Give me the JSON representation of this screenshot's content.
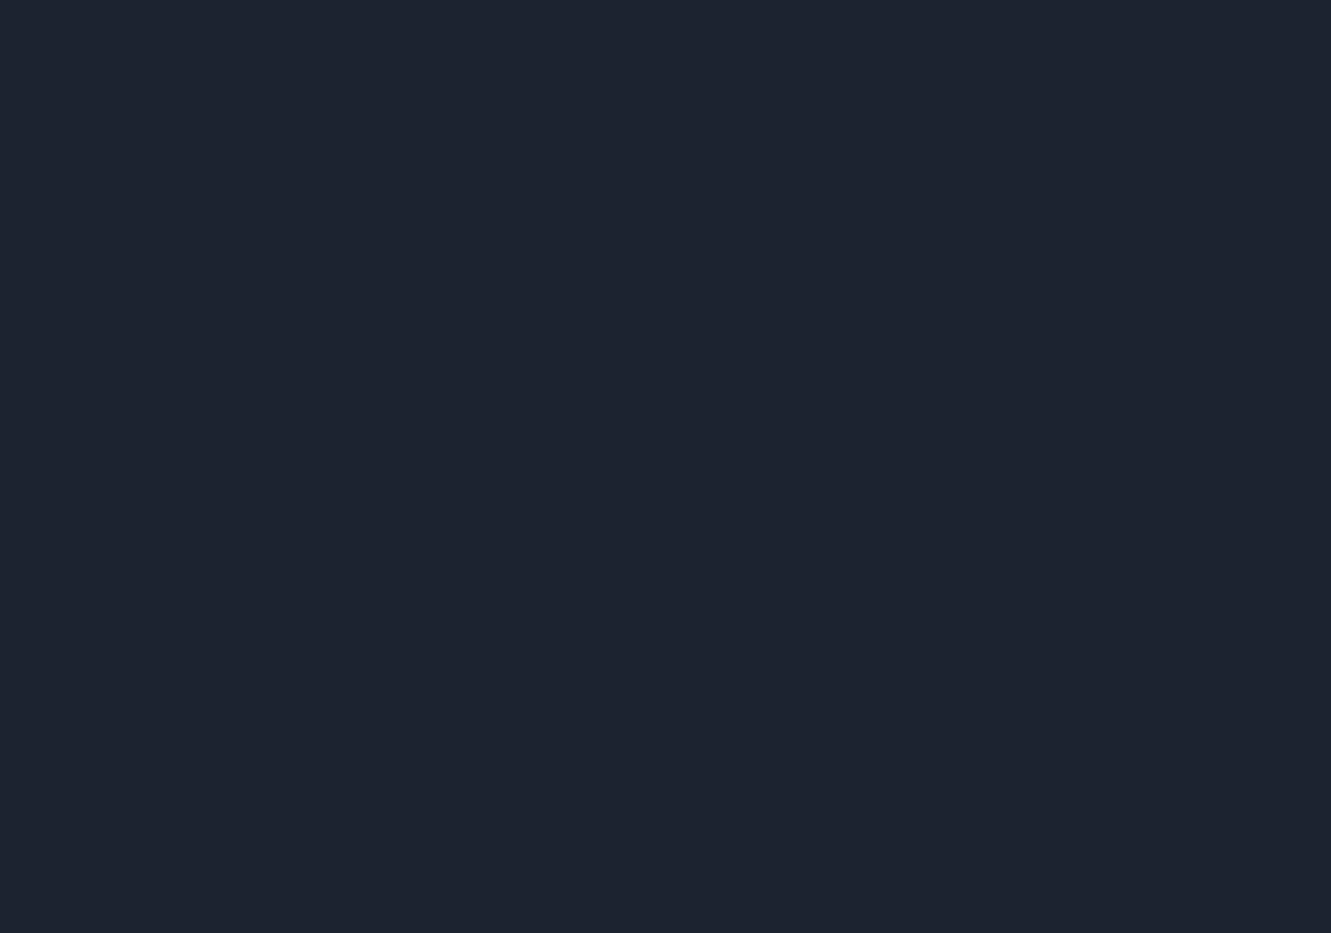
{
  "scene": {
    "description": "Dusk aerial rendering of a residential masterplan: rows of white mid-rise apartment slabs with blue flat roofs around a lit central courtyard with pools, bounded by glowing streets with car light trails, surrounded by dark city blocks, high-rise towers in mist at top right, and drifting fog",
    "width": 1331,
    "height": 933,
    "angle": -34
  },
  "palette": {
    "bg_top": "#51608a",
    "bg_mid": "#3a465e",
    "bg_low": "#273046",
    "bg_corner": "#1c2433",
    "fog": "#c8d2e5",
    "fog_bright": "#dde6f4",
    "haze_top": "#97a5c4",
    "road_walk": "#4b5566",
    "road_asphalt": "#363e4d",
    "road_lane": "#9aa3b5",
    "trail_red": "#ff5f3e",
    "trail_orange": "#ffb27a",
    "trail_white": "#ffe3c8",
    "lamp_core": "#ffffff",
    "lamp_glow": "#ffdf9e",
    "ctx_roof_dark": "#3f495e",
    "ctx_face_dark": "#252c3b",
    "ctx_edge_dark": "#59667e",
    "ctx_roof_light": "#a9b4ca",
    "ctx_face_light": "#7b87a0",
    "ctx_edge_light": "#c7d1e2",
    "ctx_roof_dim": "#6e81a5",
    "ctx_face_dim": "#b9c0cd",
    "tower_roof": "#a8b6cf",
    "tower_body": "#73819b",
    "tree_dark1": "#1b2520",
    "tree_dark2": "#23301f",
    "tree_dark3": "#2a3a2c",
    "tree_dark4": "#202b2b",
    "tree_green": "#44613a",
    "tree_green2": "#567244",
    "tree_autumn": "#a05c2f",
    "tree_autumn2": "#c08a3e",
    "tree_lit": "#cfc050",
    "site_ground": "#39463c",
    "site_path": "#c9bfa4",
    "fence_light": "#d6df7a",
    "roof_blue": "#5d78ab",
    "roof_panel": "#4d68a0",
    "roof_stroke": "#41598a",
    "roof_hilite": "#9db1d8",
    "roof_unit": "#2c4176",
    "roof_unit_top": "#7a90c0",
    "roof_ledge": "#e4e87e",
    "facade_hi": "#efece2",
    "facade_lo": "#c4ccd8",
    "facade_end": "#ced4dd",
    "floor_line": "#525a68",
    "window_lit": "#ffd286",
    "base_glow": "#ffae4f",
    "lawn": "#6f9a49",
    "lawn_bright": "#8db558",
    "garden": "#5d8a43",
    "hedge": "#2b4726",
    "pool": "#35c2c8",
    "pool_edge": "#7fe3e4",
    "canal": "#1e5f5c",
    "canal_edge": "#2e8a84",
    "deck": "#cfc9b2",
    "plaza": "#96826a",
    "club_roof": "#e9edf3",
    "club_roof2": "#dde3ec",
    "club_trim": "#c3ccd8",
    "club_sky": "#aebacb",
    "tile_roof": "#b06a40",
    "tile_stripe": "#8d4f2c",
    "tile_wing": "#a9653c",
    "court_out": "#3a5c8e",
    "court_in": "#4e7b52",
    "court_line": "#dfe8df",
    "vignette": "#0c1220"
  },
  "roads": [
    {
      "id": "nw-boundary",
      "path": "M0,772 L335,535 L765,195 L1020,0",
      "width": 24,
      "major": true
    },
    {
      "id": "sw-boundary",
      "path": "M0,290 L335,535 Q520,690 665,800 Q740,872 790,933",
      "width": 24,
      "major": true
    },
    {
      "id": "se-boundary",
      "path": "M495,933 L665,800 L880,665 Q1045,505 1225,375 L1331,325",
      "width": 26,
      "major": true
    },
    {
      "id": "ne-boundary",
      "path": "M640,58 L870,238 Q1030,355 1000,470 Q945,600 875,662",
      "width": 20,
      "major": true
    },
    {
      "id": "upper-left",
      "path": "M0,362 L250,205 L565,0",
      "width": 18,
      "major": true
    },
    {
      "id": "far-corner",
      "path": "M0,170 L230,0",
      "width": 14,
      "major": false
    },
    {
      "id": "left-cross-a",
      "path": "M105,0 L300,155 Q420,260 460,425",
      "width": 14,
      "major": false
    },
    {
      "id": "left-cross-b",
      "path": "M0,55 L218,223 Q330,330 415,465",
      "width": 14,
      "major": false
    },
    {
      "id": "bottom-left-v",
      "path": "M0,548 Q180,680 300,800 Q370,872 420,933",
      "width": 16,
      "major": false
    },
    {
      "id": "bottom-left-u",
      "path": "M114,933 L300,790 L445,672",
      "width": 14,
      "major": false
    },
    {
      "id": "corner-br",
      "path": "M1230,933 L1331,855",
      "width": 14,
      "major": false
    },
    {
      "id": "corner-tr",
      "path": "M1100,0 L1240,110 L1331,200",
      "width": 14,
      "major": false
    }
  ],
  "crosswalk_nodes": [
    [
      335,
      535
    ],
    [
      665,
      800
    ],
    [
      880,
      665
    ],
    [
      415,
      465
    ],
    [
      300,
      790
    ],
    [
      218,
      223
    ]
  ],
  "context": {
    "dark_slabs": [
      [
        70,
        62,
        150
      ],
      [
        195,
        108,
        150
      ],
      [
        318,
        156,
        150
      ],
      [
        440,
        205,
        140
      ],
      [
        92,
        212,
        170
      ],
      [
        215,
        262,
        170
      ],
      [
        338,
        310,
        150
      ],
      [
        60,
        352,
        150
      ],
      [
        185,
        402,
        150
      ],
      [
        305,
        452,
        130
      ],
      [
        68,
        470,
        150
      ],
      [
        185,
        520,
        140
      ],
      [
        75,
        622,
        170
      ],
      [
        200,
        672,
        170
      ],
      [
        322,
        722,
        150
      ],
      [
        95,
        765,
        170
      ],
      [
        218,
        815,
        170
      ],
      [
        338,
        863,
        150
      ],
      [
        80,
        898,
        150
      ],
      [
        612,
        893,
        110
      ],
      [
        848,
        852,
        150
      ],
      [
        950,
        800,
        150
      ],
      [
        1235,
        285,
        140
      ],
      [
        1300,
        338,
        130
      ],
      [
        1195,
        520,
        140
      ],
      [
        1272,
        572,
        140
      ]
    ],
    "long_slabs": [
      [
        1078,
        608,
        240
      ],
      [
        1210,
        668,
        240
      ],
      [
        1325,
        728,
        200
      ],
      [
        1048,
        700,
        240
      ],
      [
        1180,
        760,
        240
      ],
      [
        1308,
        820,
        200
      ],
      [
        1022,
        792,
        220
      ],
      [
        1150,
        852,
        220
      ],
      [
        1282,
        908,
        200
      ]
    ],
    "light_slabs": [
      [
        512,
        96,
        150
      ],
      [
        633,
        143,
        150
      ],
      [
        610,
        28,
        140
      ],
      [
        735,
        72,
        140
      ],
      [
        485,
        30,
        130
      ],
      [
        860,
        20,
        120
      ]
    ],
    "dim_slabs": [
      [
        1045,
        335,
        92
      ],
      [
        1096,
        381,
        92
      ]
    ],
    "towers": [
      [
        935,
        152
      ],
      [
        1000,
        88
      ],
      [
        1068,
        42
      ],
      [
        1108,
        142
      ],
      [
        1187,
        96
      ],
      [
        1262,
        145
      ],
      [
        1318,
        72
      ],
      [
        1040,
        218
      ],
      [
        1150,
        38
      ]
    ],
    "big_tower": [
      1078,
      182
    ]
  },
  "trees": {
    "context_clusters": [
      [
        390,
        480,
        30
      ],
      [
        470,
        420,
        26
      ],
      [
        560,
        350,
        28
      ],
      [
        650,
        285,
        26
      ],
      [
        740,
        225,
        24
      ],
      [
        830,
        160,
        26
      ],
      [
        920,
        105,
        24
      ],
      [
        300,
        560,
        34
      ],
      [
        220,
        620,
        30
      ],
      [
        140,
        560,
        26
      ],
      [
        60,
        520,
        24
      ],
      [
        255,
        470,
        24
      ],
      [
        180,
        420,
        22
      ],
      [
        105,
        370,
        22
      ],
      [
        150,
        160,
        30
      ],
      [
        270,
        210,
        28
      ],
      [
        390,
        260,
        26
      ],
      [
        40,
        260,
        26
      ],
      [
        160,
        310,
        26
      ],
      [
        280,
        360,
        24
      ],
      [
        60,
        120,
        24
      ],
      [
        350,
        120,
        24
      ],
      [
        470,
        160,
        24
      ],
      [
        500,
        260,
        22
      ],
      [
        420,
        40,
        22
      ],
      [
        240,
        70,
        24
      ],
      [
        100,
        40,
        22
      ],
      [
        560,
        130,
        24
      ],
      [
        680,
        170,
        24
      ],
      [
        790,
        120,
        26
      ],
      [
        700,
        30,
        22
      ],
      [
        580,
        60,
        22
      ],
      [
        860,
        60,
        24
      ],
      [
        950,
        215,
        30
      ],
      [
        1030,
        260,
        28
      ],
      [
        1120,
        250,
        26
      ],
      [
        1210,
        200,
        26
      ],
      [
        1290,
        235,
        24
      ],
      [
        1180,
        160,
        22
      ],
      [
        1090,
        300,
        26
      ],
      [
        1170,
        350,
        24
      ],
      [
        1255,
        400,
        26
      ],
      [
        1320,
        450,
        24
      ],
      [
        1120,
        470,
        26
      ],
      [
        1200,
        470,
        22
      ],
      [
        1010,
        640,
        28
      ],
      [
        1130,
        700,
        28
      ],
      [
        1255,
        755,
        26
      ],
      [
        990,
        735,
        26
      ],
      [
        1110,
        795,
        26
      ],
      [
        1235,
        855,
        26
      ],
      [
        980,
        840,
        26
      ],
      [
        1100,
        895,
        26
      ],
      [
        1310,
        640,
        22
      ],
      [
        920,
        700,
        30
      ],
      [
        840,
        760,
        28
      ],
      [
        760,
        830,
        28
      ],
      [
        690,
        880,
        26
      ],
      [
        580,
        860,
        24
      ],
      [
        520,
        905,
        24
      ],
      [
        420,
        600,
        36
      ],
      [
        350,
        660,
        40
      ],
      [
        260,
        720,
        40
      ],
      [
        160,
        700,
        36
      ],
      [
        80,
        680,
        32
      ],
      [
        420,
        730,
        34
      ],
      [
        350,
        800,
        36
      ],
      [
        250,
        860,
        38
      ],
      [
        150,
        860,
        34
      ],
      [
        60,
        800,
        32
      ],
      [
        440,
        860,
        30
      ],
      [
        520,
        790,
        28
      ],
      [
        40,
        430,
        22
      ],
      [
        120,
        440,
        20
      ]
    ],
    "site_clusters": [
      [
        455,
        475,
        14,
        "l"
      ],
      [
        545,
        414,
        13,
        "a"
      ],
      [
        635,
        353,
        13,
        "g"
      ],
      [
        725,
        292,
        12,
        "l"
      ],
      [
        815,
        231,
        12,
        "g"
      ],
      [
        497,
        547,
        14,
        "a"
      ],
      [
        587,
        486,
        13,
        "l"
      ],
      [
        677,
        425,
        12,
        "g"
      ],
      [
        767,
        364,
        13,
        "a"
      ],
      [
        857,
        303,
        12,
        "l"
      ],
      [
        539,
        583,
        13,
        "g"
      ],
      [
        629,
        522,
        14,
        "l"
      ],
      [
        719,
        461,
        12,
        "a"
      ],
      [
        899,
        339,
        12,
        "g"
      ],
      [
        581,
        619,
        13,
        "a"
      ],
      [
        671,
        558,
        13,
        "g"
      ],
      [
        851,
        436,
        12,
        "l"
      ],
      [
        941,
        375,
        12,
        "a"
      ],
      [
        623,
        655,
        13,
        "l"
      ],
      [
        713,
        594,
        13,
        "a"
      ],
      [
        803,
        533,
        12,
        "g"
      ],
      [
        983,
        411,
        12,
        "g"
      ],
      [
        665,
        691,
        13,
        "g"
      ],
      [
        755,
        630,
        12,
        "l"
      ],
      [
        845,
        569,
        12,
        "a"
      ],
      [
        935,
        508,
        12,
        "g"
      ],
      [
        707,
        727,
        12,
        "a"
      ],
      [
        797,
        666,
        12,
        "g"
      ],
      [
        887,
        605,
        12,
        "l"
      ],
      [
        380,
        520,
        16,
        "g"
      ],
      [
        775,
        210,
        13,
        "g"
      ],
      [
        1020,
        455,
        13,
        "g"
      ],
      [
        640,
        775,
        14,
        "g"
      ],
      [
        905,
        650,
        13,
        "g"
      ]
    ]
  },
  "site": {
    "outline": [
      [
        335,
        535
      ],
      [
        765,
        195
      ],
      [
        865,
        235
      ],
      [
        1005,
        345
      ],
      [
        1045,
        440
      ],
      [
        955,
        615
      ],
      [
        880,
        665
      ],
      [
        665,
        800
      ]
    ],
    "buildings": [
      [
        420,
        502,
        100
      ],
      [
        510,
        441,
        100
      ],
      [
        600,
        380,
        100
      ],
      [
        690,
        319,
        100
      ],
      [
        780,
        258,
        96
      ],
      [
        462,
        538,
        108
      ],
      [
        552,
        477,
        108
      ],
      [
        642,
        416,
        104
      ],
      [
        732,
        355,
        104
      ],
      [
        822,
        294,
        100
      ],
      [
        504,
        574,
        118
      ],
      [
        594,
        513,
        112
      ],
      [
        864,
        330,
        104
      ],
      [
        546,
        610,
        118
      ],
      [
        636,
        549,
        118
      ],
      [
        816,
        427,
        108
      ],
      [
        906,
        366,
        104
      ],
      [
        588,
        646,
        112
      ],
      [
        678,
        585,
        112
      ],
      [
        768,
        524,
        106
      ],
      [
        948,
        402,
        100
      ],
      [
        630,
        682,
        118
      ],
      [
        720,
        621,
        112
      ],
      [
        810,
        560,
        104
      ],
      [
        990,
        438,
        96
      ],
      [
        672,
        718,
        108
      ],
      [
        762,
        657,
        108
      ],
      [
        852,
        596,
        104
      ],
      [
        942,
        535,
        100
      ]
    ],
    "building_depth": 19,
    "building_height": 28,
    "courtyard": {
      "lawn": [
        735,
        445,
        185,
        90
      ],
      "upper_garden": [
        790,
        385,
        150,
        46
      ],
      "hedge_ring": [
        733,
        449,
        120,
        55
      ],
      "deck": [
        740,
        460,
        70,
        30
      ],
      "pool": [
        742,
        462,
        44,
        18
      ],
      "pool_small": [
        703,
        432,
        16,
        9
      ],
      "canal": [
        818,
        508,
        92,
        13
      ],
      "plaza": [
        865,
        545,
        64,
        40
      ]
    },
    "clubhouse": {
      "roof": [
        884,
        484,
        78,
        48
      ],
      "roof_inner": [
        884,
        484,
        50,
        30
      ],
      "skylight": [
        890,
        488,
        16,
        10
      ],
      "tile_section": [
        852,
        452,
        50,
        30
      ],
      "wing": [
        868,
        516,
        34,
        20
      ]
    },
    "sports_court": {
      "center": [
        598,
        772
      ],
      "outer": [
        48,
        28
      ],
      "inner": [
        36,
        20
      ]
    }
  },
  "fog": [
    [
      140,
      140,
      260,
      150,
      0.48
    ],
    [
      420,
      60,
      220,
      90,
      0.35
    ],
    [
      700,
      45,
      240,
      80,
      0.3
    ],
    [
      1090,
      120,
      300,
      130,
      0.5
    ],
    [
      1270,
      300,
      180,
      120,
      0.35
    ],
    [
      1240,
      560,
      220,
      130,
      0.3
    ],
    [
      60,
      460,
      140,
      130,
      0.35
    ],
    [
      120,
      800,
      240,
      140,
      0.42
    ],
    [
      420,
      890,
      200,
      90,
      0.3
    ],
    [
      900,
      880,
      260,
      110,
      0.3
    ],
    [
      1180,
      780,
      220,
      120,
      0.28
    ],
    [
      350,
      640,
      160,
      80,
      0.22
    ],
    [
      1010,
      420,
      150,
      90,
      0.22
    ],
    [
      30,
      300,
      120,
      100,
      0.3
    ],
    [
      1320,
      60,
      160,
      90,
      0.4
    ]
  ],
  "vehicles": [
    [
      228,
      190,
      -33,
      "#e8edf5"
    ],
    [
      410,
      597,
      38,
      "#d8dde6"
    ],
    [
      940,
      560,
      68,
      "#f3c33c"
    ],
    [
      760,
      740,
      -32,
      "#f3c33c"
    ],
    [
      1180,
      402,
      -33,
      "#c7cdd8"
    ],
    [
      560,
      845,
      41,
      "#e8edf5"
    ]
  ],
  "lights": {
    "lamp_spacing": 78
  }
}
